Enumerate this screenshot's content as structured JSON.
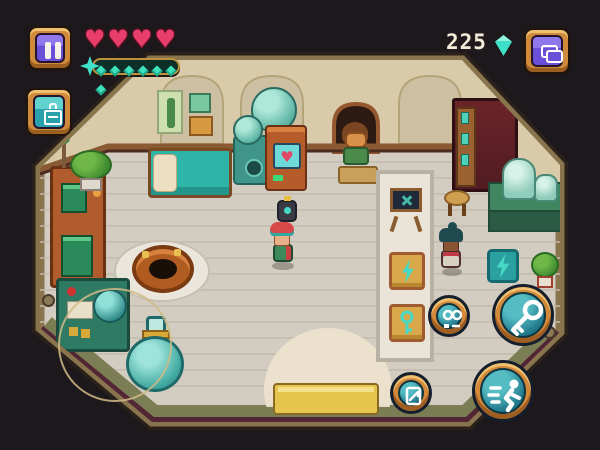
{
  "app": {
    "name": "Pixel alchemy shop game screen"
  },
  "hud": {
    "pause_button": {
      "icon": "pause-icon"
    },
    "health": {
      "hearts": 4,
      "heart_color": "#e83e6e"
    },
    "energy": {
      "segments": 7,
      "segment_color": "#3fe0be",
      "icon": "spark-star-icon"
    },
    "currency": {
      "amount": "225",
      "icon": "gem-icon",
      "gem_color": "#3fe0c8"
    },
    "inventory_button": {
      "icon": "satchel-icon",
      "color": "#6a4fd8"
    },
    "register_button": {
      "icon": "register-icon",
      "color": "#2aa0ac"
    },
    "joystick": {
      "kind": "virtual-joystick-ring"
    },
    "interact_button": {
      "icon": "key-icon"
    },
    "dash_button": {
      "icon": "dash-runner-icon"
    },
    "edit_button": {
      "icon": "blueprint-icon"
    }
  },
  "scene": {
    "room": "octagonal alchemy shop interior",
    "player": {
      "name": "player-character",
      "marker": "attention-eye-marker"
    },
    "npcs": [
      "squirrel-customer-in-alcove",
      "browsing-customer"
    ],
    "request_badge": {
      "icon": "goggles-request-icon"
    },
    "furniture": [
      "bed",
      "wall-posters",
      "alchemy-still",
      "fireplace-alcove",
      "potion-cabinet",
      "stool",
      "lab-table-with-jars",
      "display-carpet",
      "easel-sign",
      "bolt-display-tile",
      "key-display-tile",
      "wall-bolt-tile",
      "potted-plant",
      "cauldron",
      "orange-console",
      "counter-machine",
      "giant-flask",
      "potted-bush",
      "entrance-mat"
    ]
  },
  "colors": {
    "background": "#1c181b",
    "floor": "#d2ccc1",
    "wall": "#d9cba9",
    "frame": "#8a744e",
    "accent_orange": "#d4883a",
    "accent_teal": "#2aa0ac",
    "accent_purple": "#6a4fd8"
  }
}
